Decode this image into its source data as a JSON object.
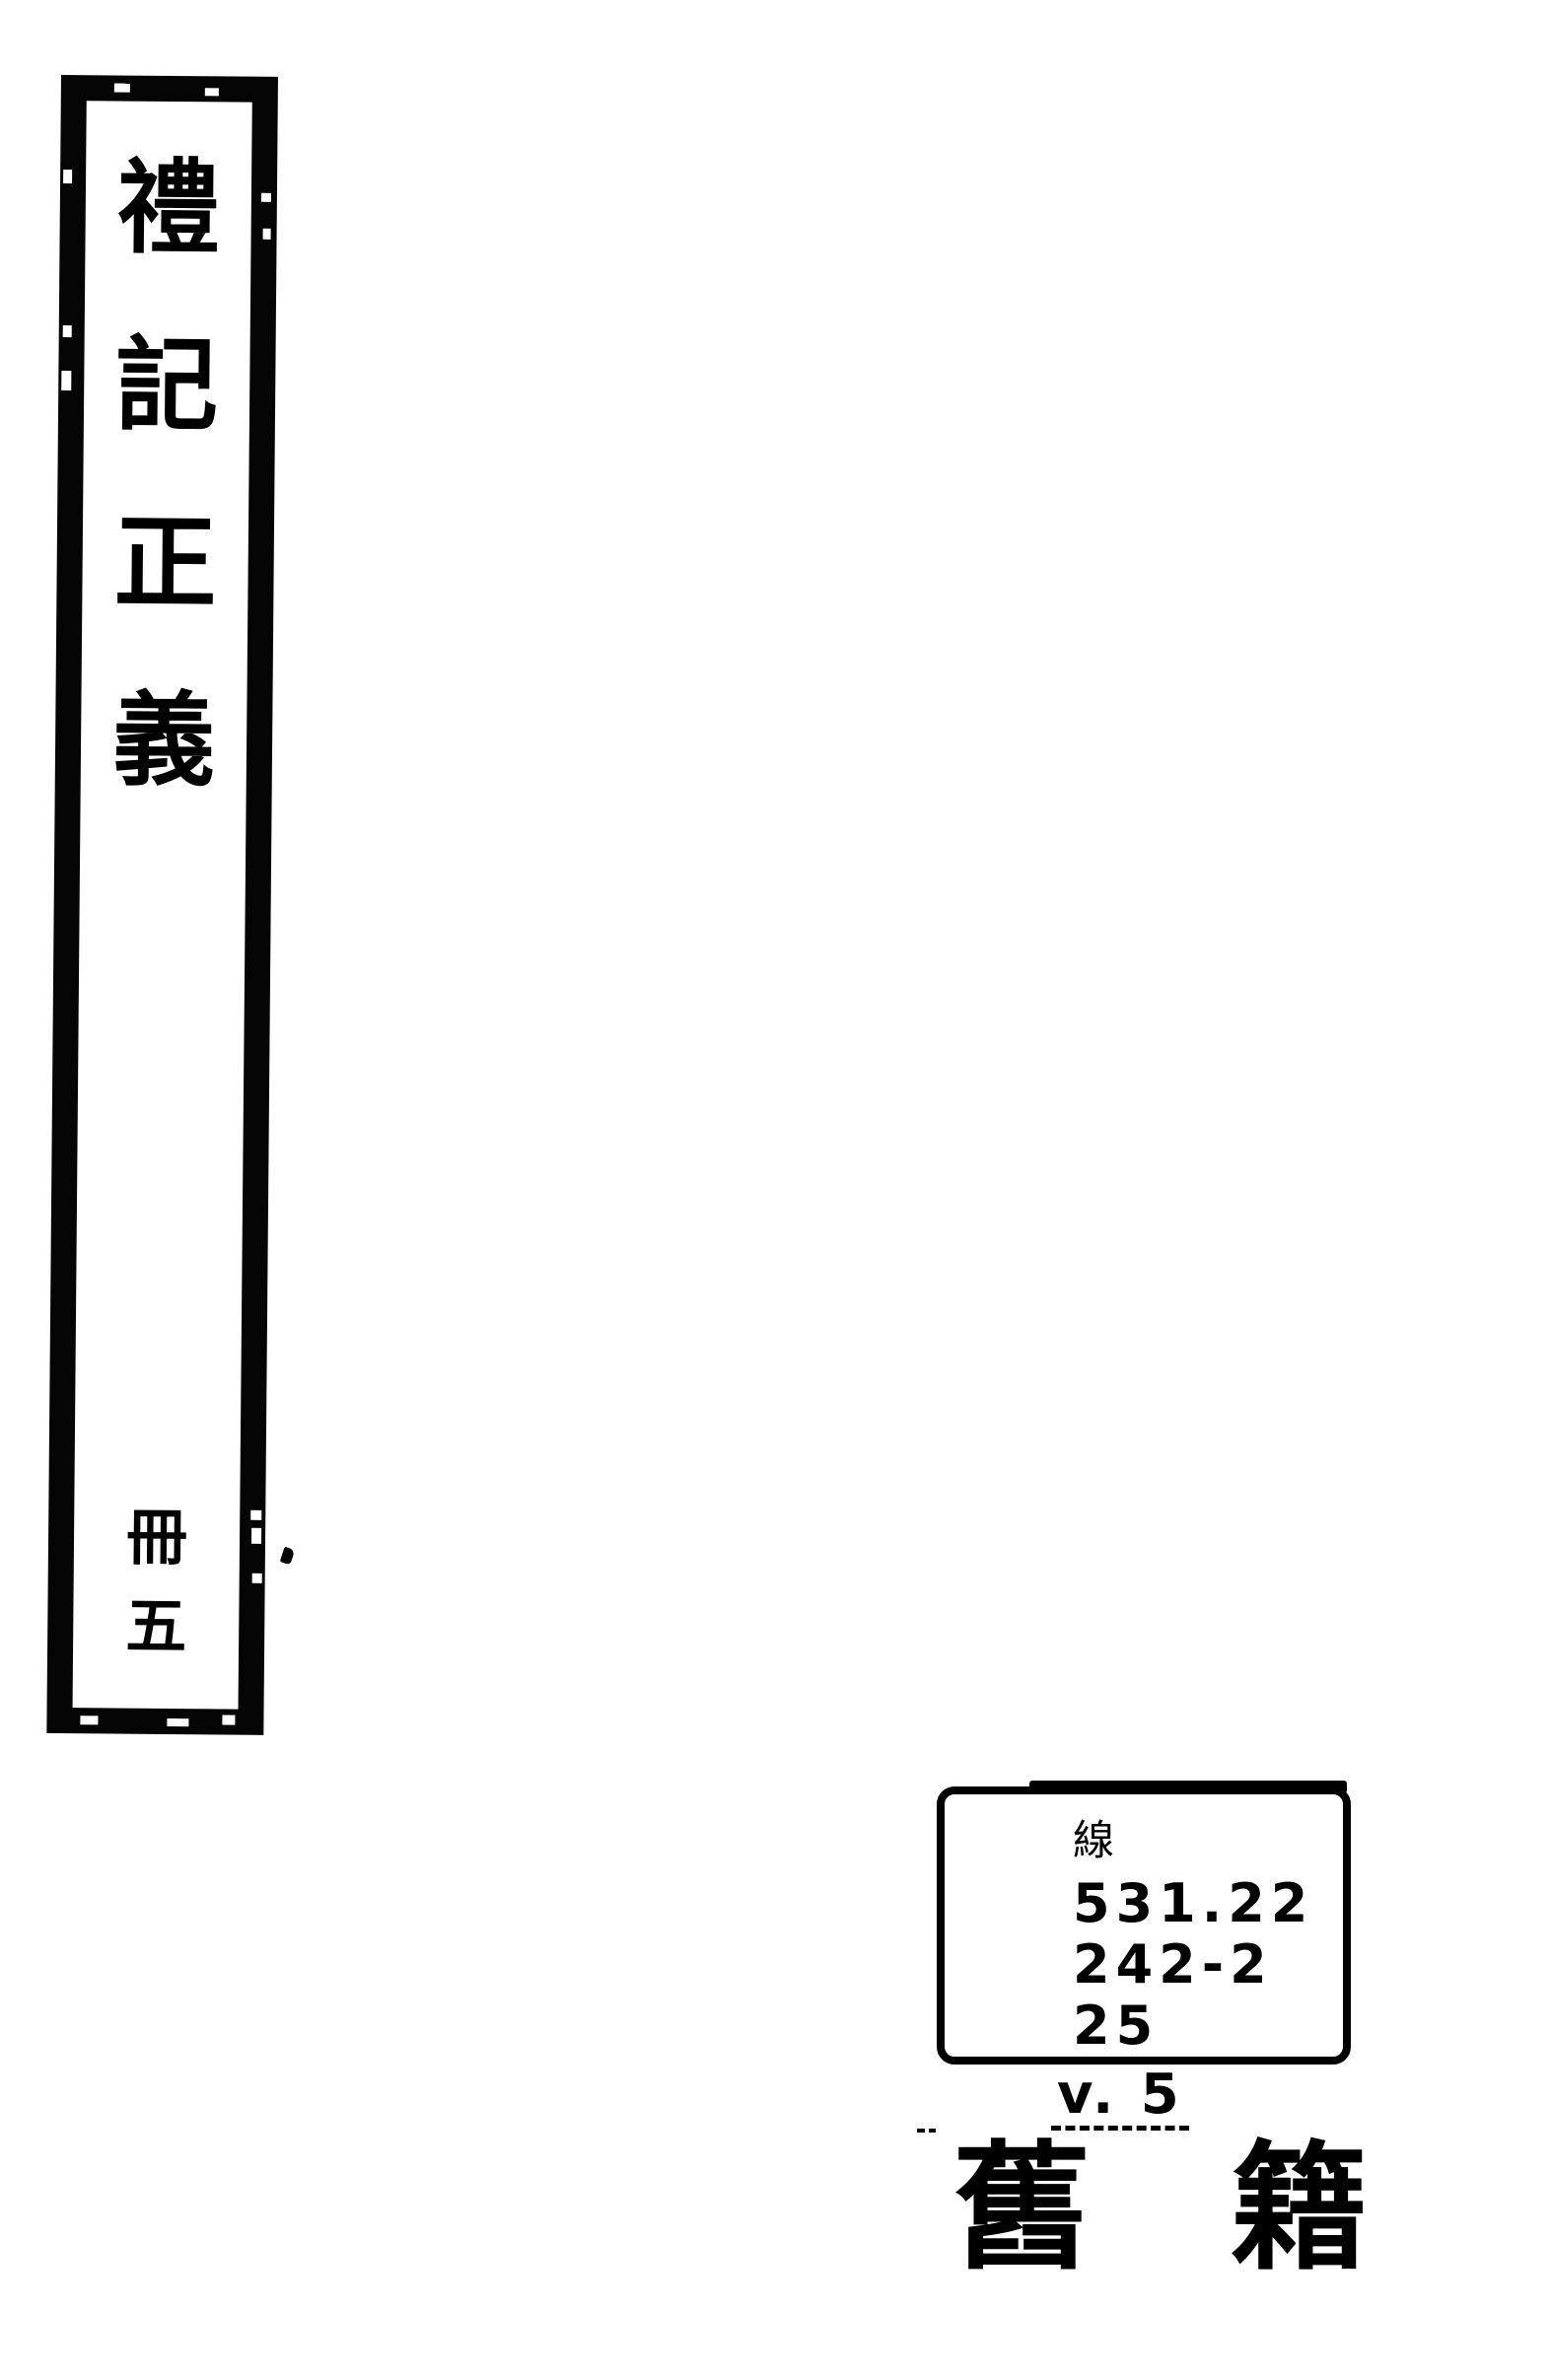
{
  "spine": {
    "title": "禮記正義",
    "title_chars": [
      "禮",
      "記",
      "正",
      "義"
    ],
    "volume": "冊五",
    "volume_chars": [
      "冊",
      "五"
    ]
  },
  "call_label": {
    "class_char": "線",
    "lines": [
      "531.22",
      "242-2",
      "25"
    ],
    "volume": "v. 5"
  },
  "stamp": {
    "text": "舊籍",
    "chars": [
      "舊",
      "籍"
    ]
  },
  "colors": {
    "ink": "#000000",
    "paper": "#ffffff"
  }
}
